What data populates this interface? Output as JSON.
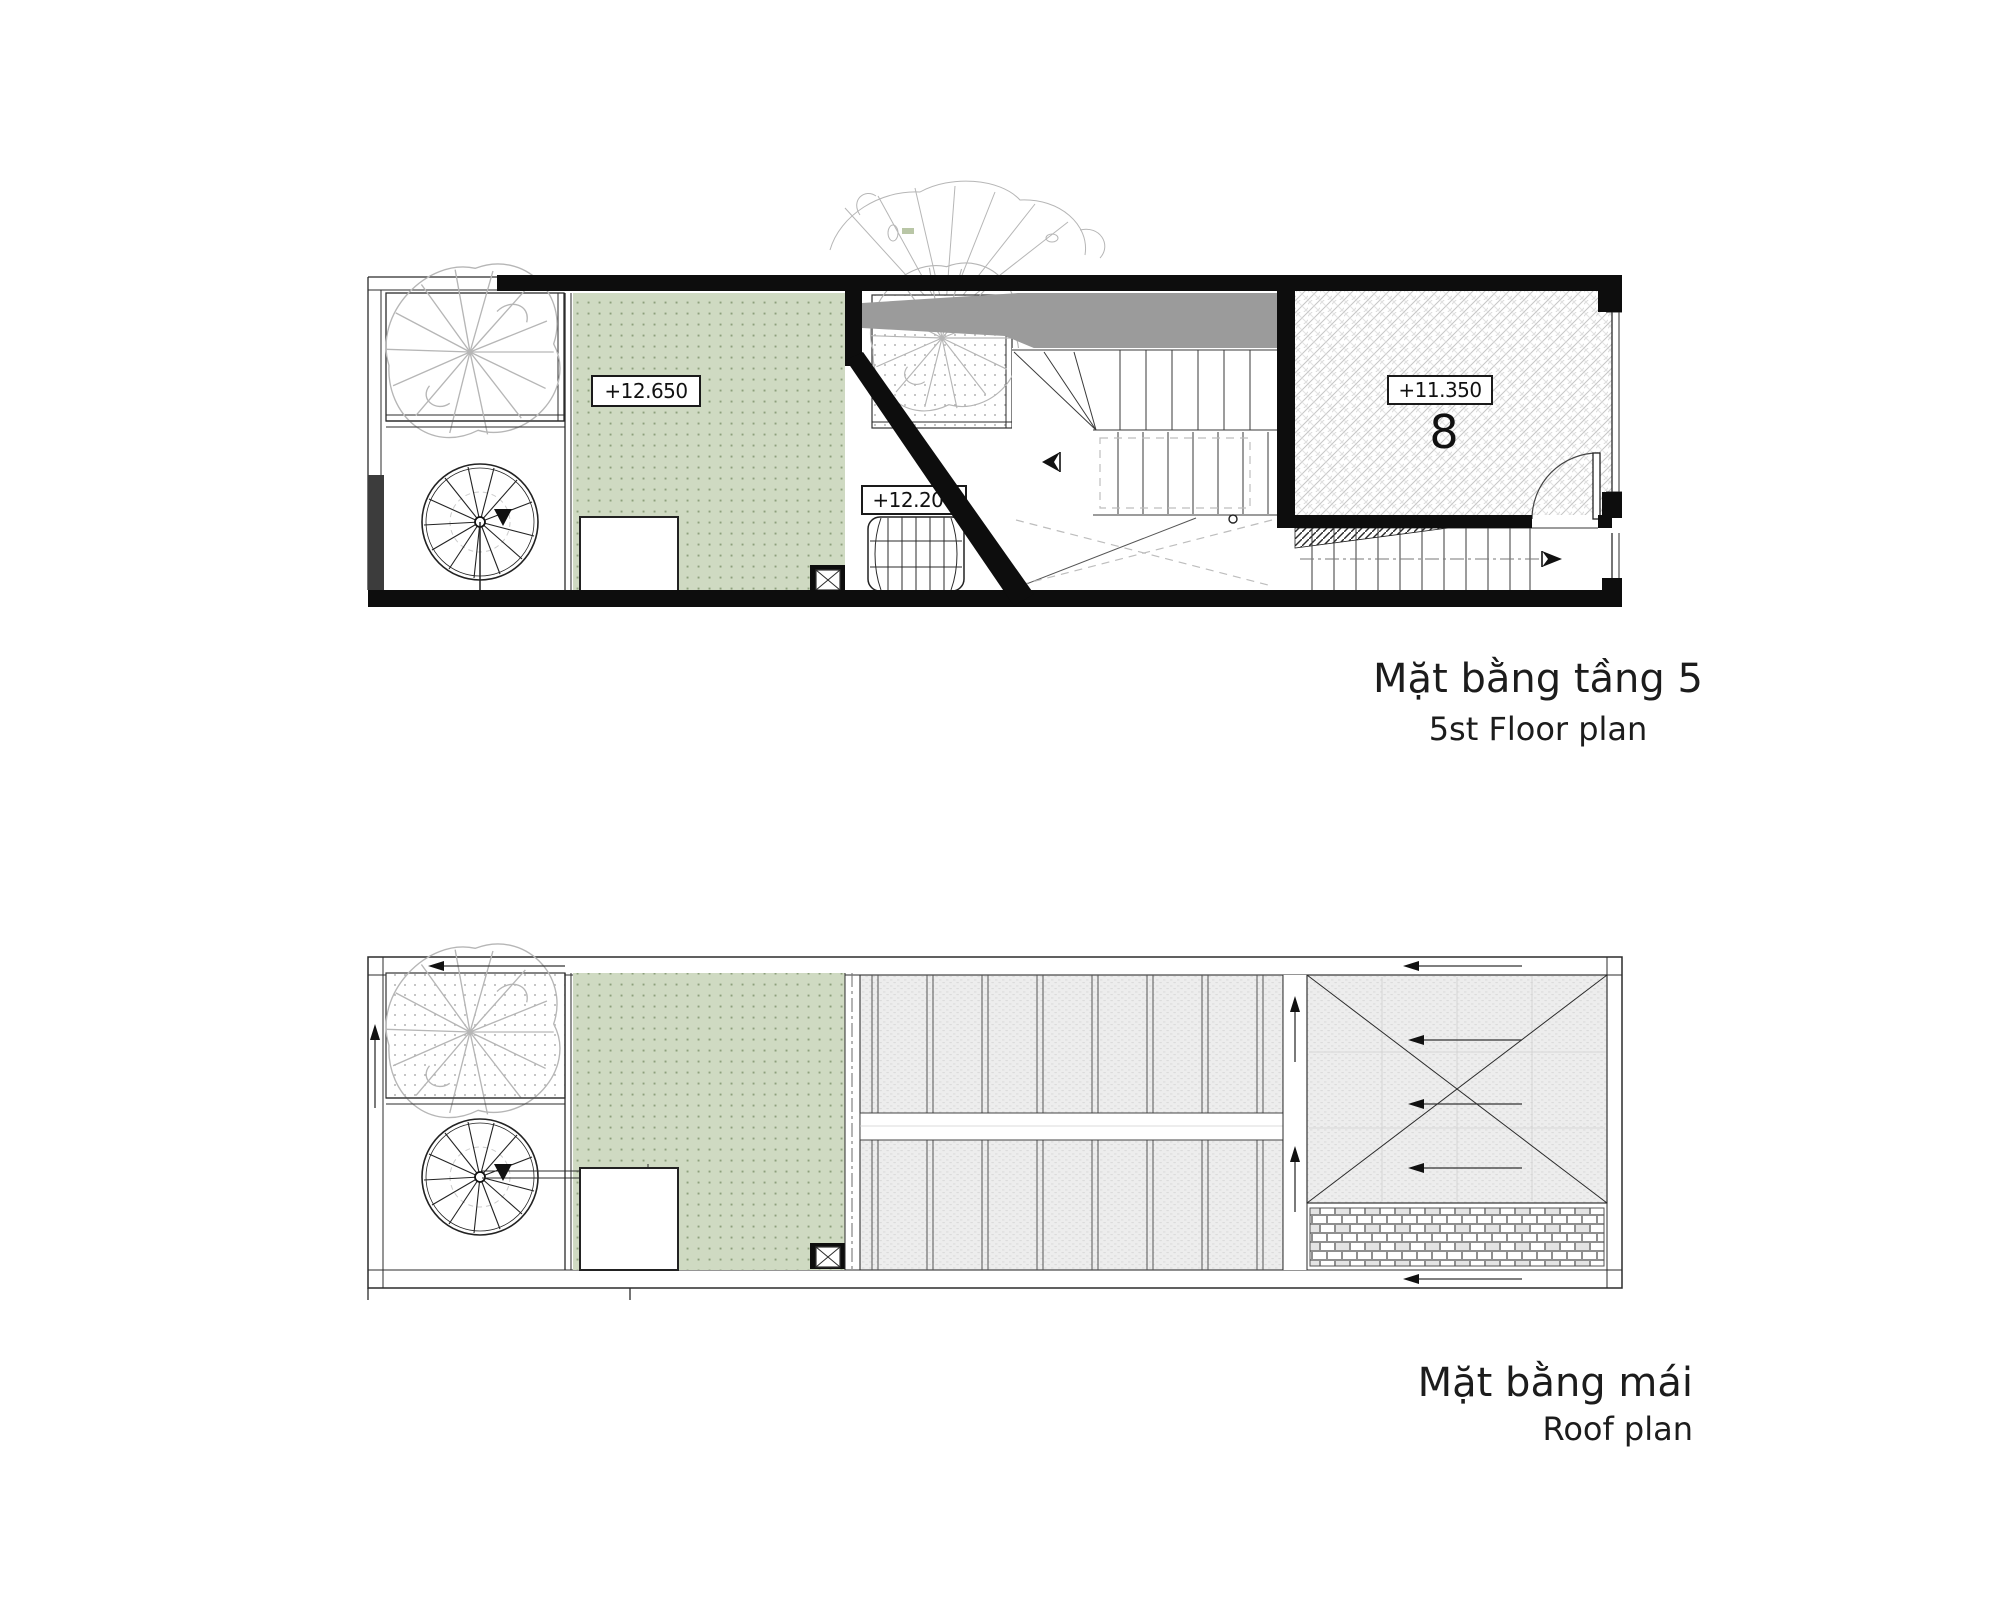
{
  "floor5_plan": {
    "title_vi": "Mặt bằng tầng 5",
    "title_en": "5st Floor plan",
    "labels": {
      "terrace_level": "+12.650",
      "stair_hall_level": "+12.200",
      "room_level": "+11.350",
      "room_number": "8"
    }
  },
  "roof_plan": {
    "title_vi": "Mặt bằng mái",
    "title_en": "Roof plan"
  },
  "colors": {
    "wall": "#0d0d0d",
    "line": "#2b2b2b",
    "terrace_green": "#cfdac2",
    "terrace_green_dot": "#8da07c",
    "shadow": "#9b9b9b",
    "roof_sheet_gray": "#ededed",
    "tree_line": "#b6b6b6",
    "text": "#1c1c1c",
    "background": "#ffffff"
  }
}
